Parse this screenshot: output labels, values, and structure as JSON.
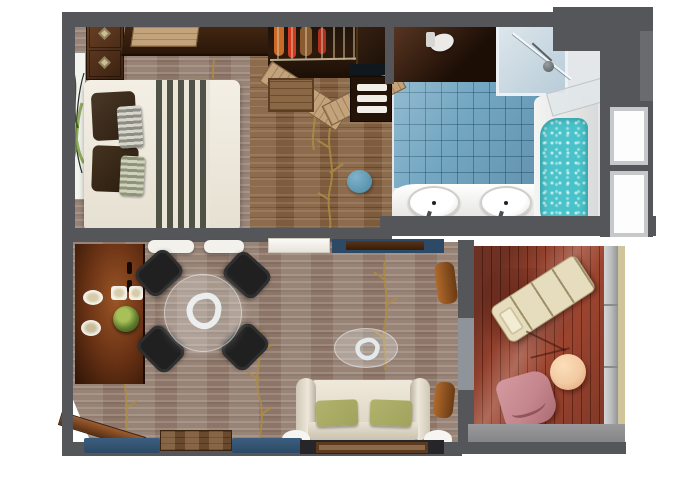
{
  "title": "suite-floor-plan",
  "palette": {
    "bg": "#ffffff",
    "wall": "#55565a",
    "wall_light": "#6a6b6e",
    "carpet": "#8d7668",
    "branch": "#ad8c42",
    "wood": "#7d5b3c",
    "wood_light": "#c3a37c",
    "wood_dark": "#33200f",
    "closet_dark": "#20130a",
    "tile": "#74a7c2",
    "water": "#49c3c9",
    "bath_white": "#e4e7ea",
    "deck": "#9c4530",
    "railing": "#bcbdbf",
    "railing_trim": "#cfc49a",
    "lounge": "#e6ddbe",
    "chair_pink": "#c5868d",
    "table_peach": "#f2c9a2",
    "sofa_cream": "#ddd5c4",
    "cushion_green": "#9fa35c",
    "chair_black": "#202020",
    "navy": "#2c4a66",
    "sideboard": "#6b3315"
  },
  "rooms": {
    "bedroom": {
      "name": "bedroom",
      "items": [
        "double-bed",
        "striped-bed-runner",
        "dark-pillows",
        "accent-pillows",
        "nightstand-drawers",
        "wall-artwork",
        "console-desk",
        "wardrobe-hanging-clothes",
        "wardrobe-cabinet",
        "storage-box"
      ]
    },
    "bathroom": {
      "name": "bathroom",
      "items": [
        "double-sink-vanity",
        "bathtub-with-water",
        "shower",
        "toilet",
        "towel-shelf",
        "blue-stool",
        "glass-partition"
      ],
      "sink_count": 2
    },
    "living_dining": {
      "name": "living-dining-room",
      "items": [
        "glass-dining-table",
        "dining-chairs",
        "sideboard-with-plates",
        "plant",
        "sofa",
        "green-cushions",
        "glass-coffee-table",
        "writing-desk",
        "white-ottomans",
        "entry-door",
        "window-ledge",
        "wood-step"
      ],
      "dining_chair_count": 4,
      "sofa_cushion_count": 2
    },
    "balcony": {
      "name": "balcony",
      "items": [
        "lounge-chair",
        "round-side-table",
        "outdoor-chair",
        "railing",
        "wood-deck"
      ]
    }
  }
}
